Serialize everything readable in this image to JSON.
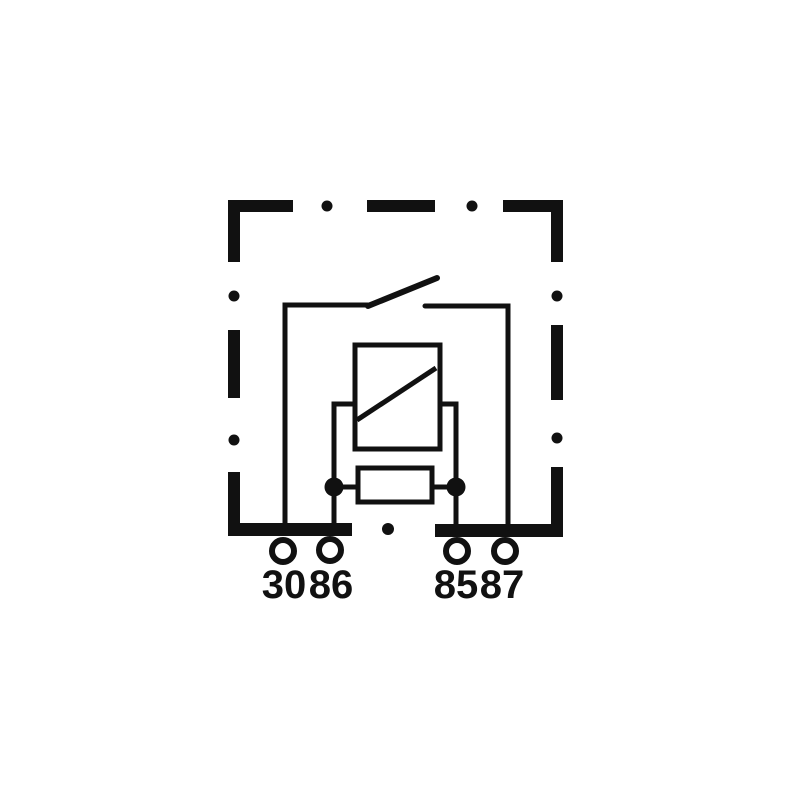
{
  "diagram": {
    "symbols": [
      "dashed-enclosure",
      "switch-contact",
      "relay-coil",
      "coil-yoke",
      "resistor",
      "junction-dots",
      "terminal-pins"
    ],
    "terminals": [
      {
        "label": "30"
      },
      {
        "label": "86"
      },
      {
        "label": "85"
      },
      {
        "label": "87"
      }
    ],
    "colors": {
      "line": "#111111",
      "background": "#ffffff"
    }
  }
}
